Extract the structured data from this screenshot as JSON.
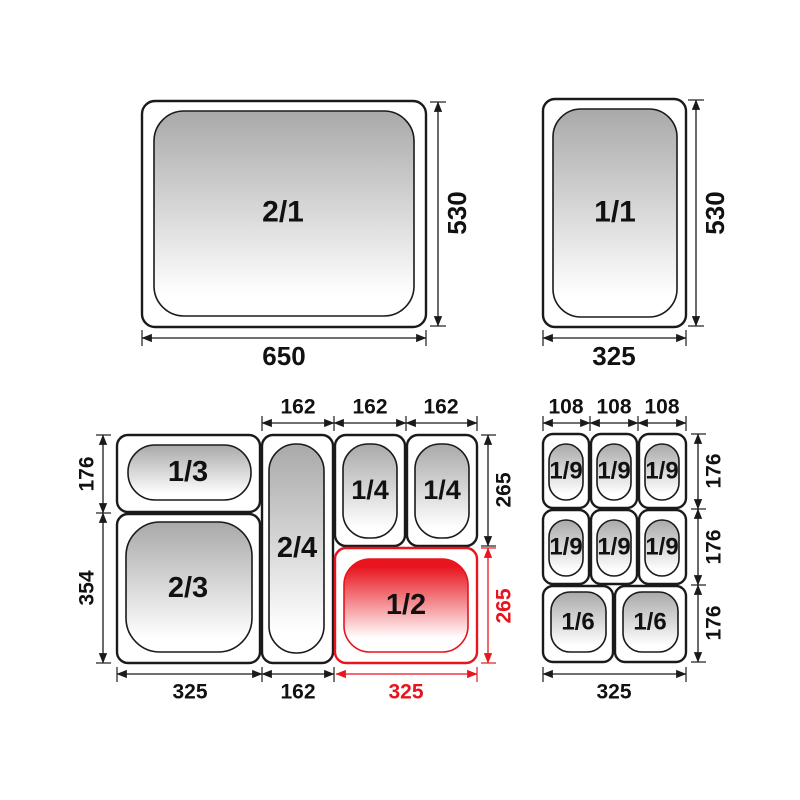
{
  "colors": {
    "ink": "#1a1a1a",
    "highlight": "#e8141e",
    "pan_gray": "#a9a9a9",
    "background": "#ffffff"
  },
  "pans": {
    "gn21": {
      "label": "2/1",
      "width_label": "650",
      "height_label": "530"
    },
    "gn11": {
      "label": "1/1",
      "width_label": "325",
      "height_label": "530"
    }
  },
  "combo_left": {
    "labels": {
      "one_third": "1/3",
      "two_thirds": "2/3",
      "two_fourths": "2/4",
      "one_fourth_a": "1/4",
      "one_fourth_b": "1/4",
      "one_half": "1/2"
    },
    "dims": {
      "top": [
        "162",
        "162",
        "162"
      ],
      "left": [
        "176",
        "354"
      ],
      "right_black": "265",
      "right_red": "265",
      "bottom_black": [
        "325",
        "162"
      ],
      "bottom_red": "325"
    }
  },
  "combo_right": {
    "labels": {
      "ninths": [
        "1/9",
        "1/9",
        "1/9",
        "1/9",
        "1/9",
        "1/9"
      ],
      "sixths": [
        "1/6",
        "1/6"
      ]
    },
    "dims": {
      "top": [
        "108",
        "108",
        "108"
      ],
      "right": [
        "176",
        "176",
        "176"
      ],
      "bottom": "325"
    }
  }
}
